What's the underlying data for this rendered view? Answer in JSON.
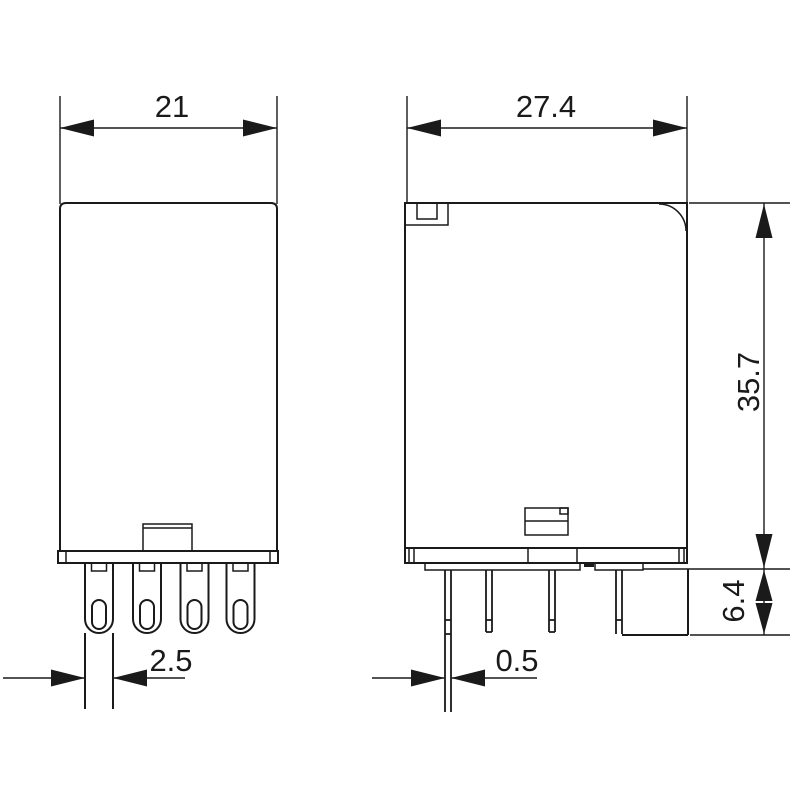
{
  "drawing": {
    "type": "technical-dimension-drawing",
    "colors": {
      "line": "#1a1a1a",
      "background": "#ffffff"
    },
    "dimensions": {
      "front_width": "21",
      "side_width": "27.4",
      "body_height": "35.7",
      "pin_length": "6.4",
      "pin_blade_width": "2.5",
      "pin_thickness": "0.5"
    }
  }
}
